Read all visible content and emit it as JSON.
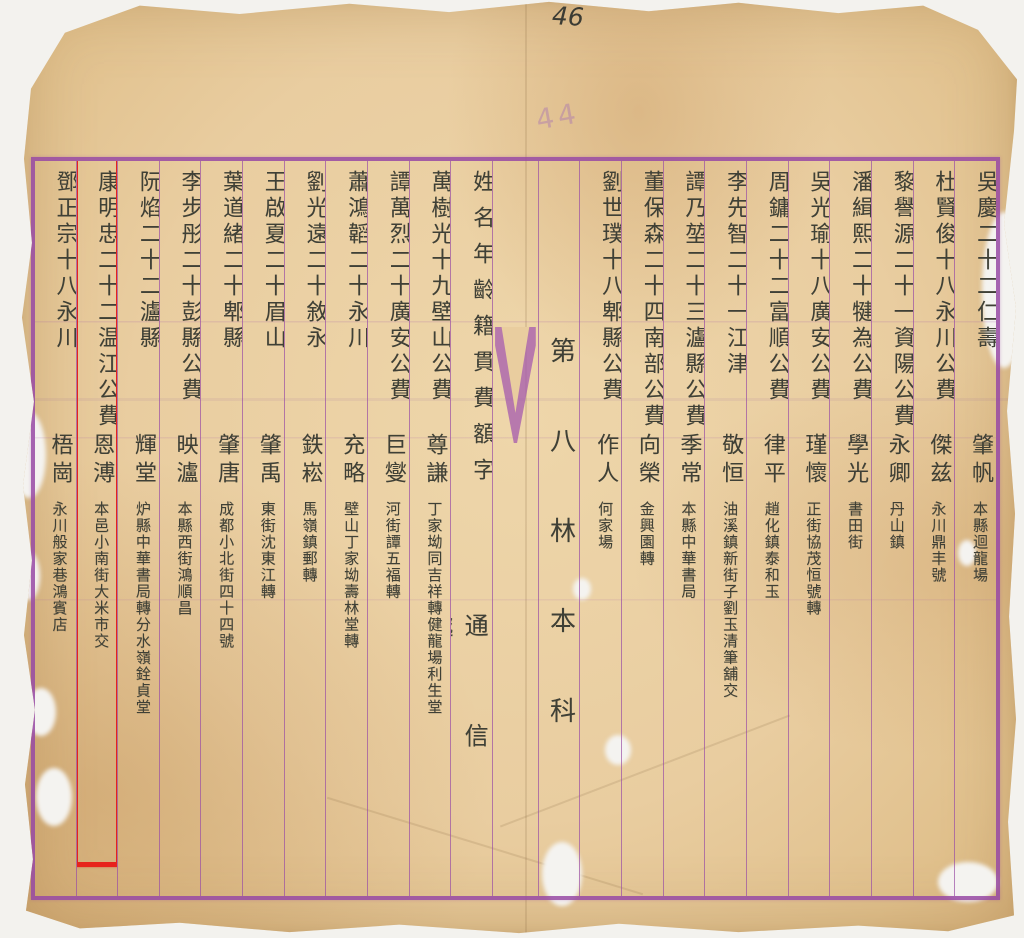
{
  "colors": {
    "paper": "#e9cda0",
    "frame_purple": "#9749a4",
    "ink": "#3f4036",
    "annotation_red": "#e7231c",
    "faint_note_purple": "#a876b2"
  },
  "page_marks": {
    "top_number": "46",
    "faint_number": "44"
  },
  "columns": [
    {
      "type": "entry",
      "main": "吳慶二十二仁壽",
      "style_name": "肇帆",
      "address": "本縣迴龍場",
      "highlighted": false
    },
    {
      "type": "entry",
      "main": "杜賢俊十八永川公費",
      "style_name": "傑兹",
      "address": "永川鼎丰號",
      "highlighted": false
    },
    {
      "type": "entry",
      "main": "黎譽源二十一資陽公費",
      "style_name": "永卿",
      "address": "丹山鎮",
      "highlighted": false
    },
    {
      "type": "entry",
      "main": "潘緝熙二十犍為公費",
      "style_name": "學光",
      "address": "書田街",
      "highlighted": false
    },
    {
      "type": "entry",
      "main": "吳光瑜十八廣安公費",
      "style_name": "瑾懷",
      "address": "正街協茂恒號轉",
      "highlighted": false
    },
    {
      "type": "entry",
      "main": "周鏞二十二富順公費",
      "style_name": "律平",
      "address": "趙化鎮泰和玉",
      "highlighted": false
    },
    {
      "type": "entry",
      "main": "李先智二十一江津",
      "style_name": "敬恒",
      "address": "油溪鎮新街子劉玉清筆舖交",
      "highlighted": false
    },
    {
      "type": "entry",
      "main": "譚乃堃二十三瀘縣公費",
      "style_name": "季常",
      "address": "本縣中華書局",
      "highlighted": false
    },
    {
      "type": "entry",
      "main": "董保森二十四南部公費",
      "style_name": "向榮",
      "address": "金興園轉",
      "highlighted": false
    },
    {
      "type": "entry",
      "main": "劉世璞十八郫縣公費",
      "style_name": "作人",
      "address": "何家場",
      "highlighted": false
    },
    {
      "type": "section",
      "label": "第八林本科"
    },
    {
      "type": "fold"
    },
    {
      "type": "header",
      "fields": "姓名年齡籍貫費額字",
      "contact": "通信處"
    },
    {
      "type": "entry",
      "main": "萬樹光十九壁山公費",
      "style_name": "尊謙",
      "address": "丁家坳同吉祥轉健龍場利生堂",
      "highlighted": false
    },
    {
      "type": "entry",
      "main": "譚萬烈二十廣安公費",
      "style_name": "巨燮",
      "address": "河街譚五福轉",
      "highlighted": false
    },
    {
      "type": "entry",
      "main": "蕭鴻韜二十永川",
      "style_name": "充略",
      "address": "壁山丁家坳壽林堂轉",
      "highlighted": false
    },
    {
      "type": "entry",
      "main": "劉光遠二十敘永",
      "style_name": "鉄崧",
      "address": "馬嶺鎮郵轉",
      "highlighted": false
    },
    {
      "type": "entry",
      "main": "王啟夏二十眉山",
      "style_name": "肇禹",
      "address": "東街沈東江轉",
      "highlighted": false
    },
    {
      "type": "entry",
      "main": "葉道緒二十郫縣",
      "style_name": "肇唐",
      "address": "成都小北街四十四號",
      "highlighted": false
    },
    {
      "type": "entry",
      "main": "李步彤二十彭縣公費",
      "style_name": "映瀘",
      "address": "本縣西街鴻順昌",
      "highlighted": false
    },
    {
      "type": "entry",
      "main": "阮焰二十二瀘縣",
      "style_name": "輝堂",
      "address": "炉縣中華書局轉分水嶺銓貞堂",
      "highlighted": false
    },
    {
      "type": "entry",
      "main": "康明忠二十二温江公費",
      "style_name": "恩溥",
      "address": "本邑小南街大米市交",
      "highlighted": true
    },
    {
      "type": "entry",
      "main": "鄧正宗十八永川",
      "style_name": "梧崗",
      "address": "永川般家巷鴻賓店",
      "highlighted": false
    }
  ]
}
